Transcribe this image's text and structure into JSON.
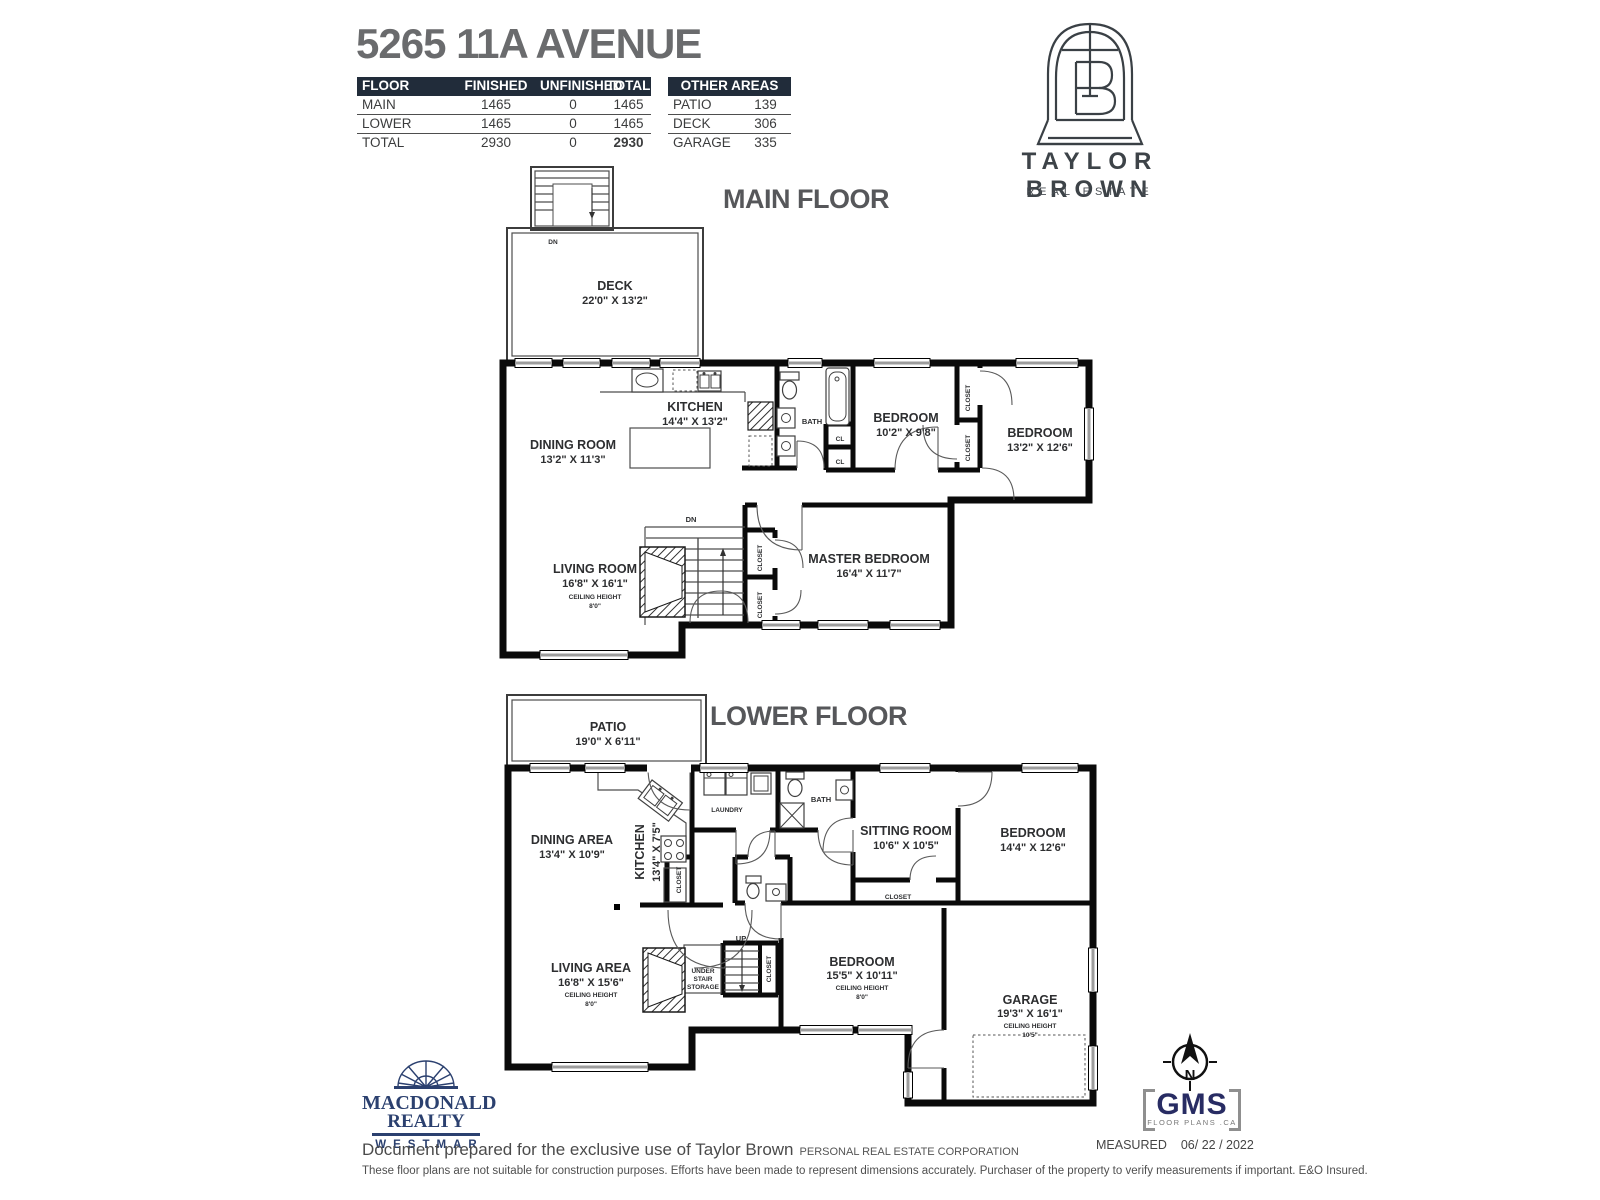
{
  "header": {
    "title": "5265 11A AVENUE",
    "floor_table": {
      "headers": [
        "FLOOR",
        "FINISHED",
        "UNFINISHED",
        "TOTAL"
      ],
      "rows": [
        {
          "floor": "MAIN",
          "finished": "1465",
          "unfinished": "0",
          "total": "1465"
        },
        {
          "floor": "LOWER",
          "finished": "1465",
          "unfinished": "0",
          "total": "1465"
        },
        {
          "floor": "TOTAL",
          "finished": "2930",
          "unfinished": "0",
          "total": "2930"
        }
      ]
    },
    "other_table": {
      "header": "OTHER AREAS",
      "rows": [
        {
          "name": "PATIO",
          "area": "139"
        },
        {
          "name": "DECK",
          "area": "306"
        },
        {
          "name": "GARAGE",
          "area": "335"
        }
      ]
    }
  },
  "brand": {
    "name": "TAYLOR BROWN",
    "tagline": "REAL ESTATE"
  },
  "shared": {
    "bath": "BATH",
    "closet": "CLOSET",
    "cl": "CL",
    "dn": "DN",
    "up": "UP",
    "ceiling": "CEILING HEIGHT",
    "ch8": "8'0\""
  },
  "main_floor": {
    "title": "MAIN FLOOR",
    "deck": "DECK",
    "deck_dims": "22'0\" X 13'2\"",
    "kitchen": "KITCHEN",
    "kitchen_dims": "14'4\" X 13'2\"",
    "dining": "DINING ROOM",
    "dining_dims": "13'2\" X 11'3\"",
    "living": "LIVING ROOM",
    "living_dims": "16'8\" X 16'1\"",
    "bed1": "BEDROOM",
    "bed1_dims": "10'2\" X 9'8\"",
    "bed2": "BEDROOM",
    "bed2_dims": "13'2\" X 12'6\"",
    "master": "MASTER BEDROOM",
    "master_dims": "16'4\" X 11'7\""
  },
  "lower_floor": {
    "title": "LOWER FLOOR",
    "patio": "PATIO",
    "patio_dims": "19'0\" X 6'11\"",
    "dining": "DINING AREA",
    "dining_dims": "13'4\" X 10'9\"",
    "kitchen": "KITCHEN",
    "kitchen_dims": "13'4\" X 7'5\"",
    "laundry": "LAUNDRY",
    "sitting": "SITTING ROOM",
    "sitting_dims": "10'6\" X 10'5\"",
    "bed1": "BEDROOM",
    "bed1_dims": "14'4\" X 12'6\"",
    "bed2": "BEDROOM",
    "bed2_dims": "15'5\" X 10'11\"",
    "living": "LIVING AREA",
    "living_dims": "16'8\" X 15'6\"",
    "garage": "GARAGE",
    "garage_dims": "19'3\" X 16'1\"",
    "garage_ch": "10'5\"",
    "under_stair_1": "UNDER",
    "under_stair_2": "STAIR",
    "under_stair_3": "STORAGE"
  },
  "footer": {
    "macdonald_line1": "MACDONALD",
    "macdonald_line2": "REALTY",
    "macdonald_line3": "WESTMAR",
    "prepared": "Document prepared for the exclusive use of Taylor Brown",
    "prepared_note": "PERSONAL REAL ESTATE CORPORATION",
    "disclaimer": "These floor plans are not suitable for construction purposes. Efforts have been made to represent dimensions accurately.  Purchaser of the property to verify measurements if important.  E&O Insured.",
    "measured_label": "MEASURED",
    "measured_value": "06/ 22 / 2022",
    "gms": "GMS",
    "gms_sub": "FLOOR PLANS .CA",
    "compass_n": "N"
  }
}
